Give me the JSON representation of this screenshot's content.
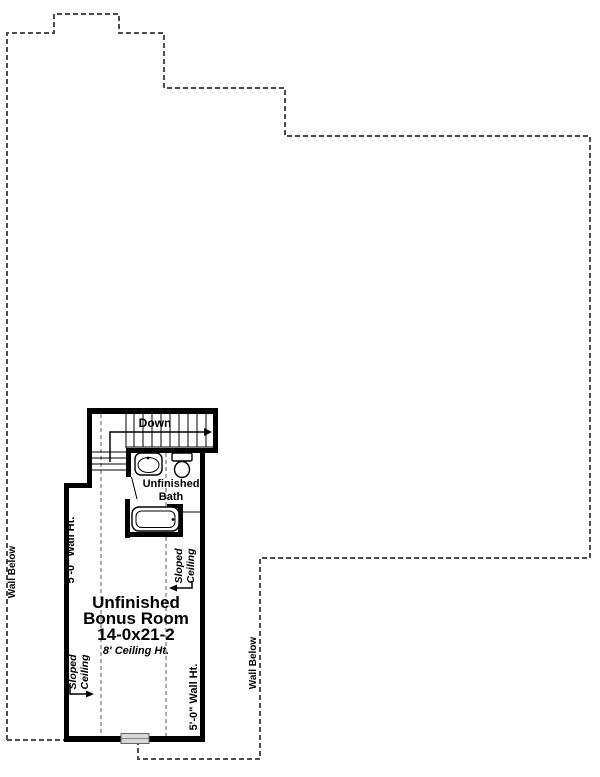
{
  "colors": {
    "background": "#ffffff",
    "wall": "#000000",
    "outline_dash": "#4d4d4d",
    "interior_dash": "#919191",
    "window_fill": "#d9d9d9"
  },
  "stairs": {
    "down_label": "Down"
  },
  "bath": {
    "label_line1": "Unfinished",
    "label_line2": "Bath"
  },
  "bonus_room": {
    "label_line1": "Unfinished",
    "label_line2": "Bonus Room",
    "dimensions": "14-0x21-2",
    "ceiling_note": "8' Ceiling Ht."
  },
  "annotations": {
    "wall_height": "5'-0\" Wall Ht.",
    "sloped_line1": "Sloped",
    "sloped_line2": "Ceiling",
    "wall_below": "Wall Below"
  }
}
